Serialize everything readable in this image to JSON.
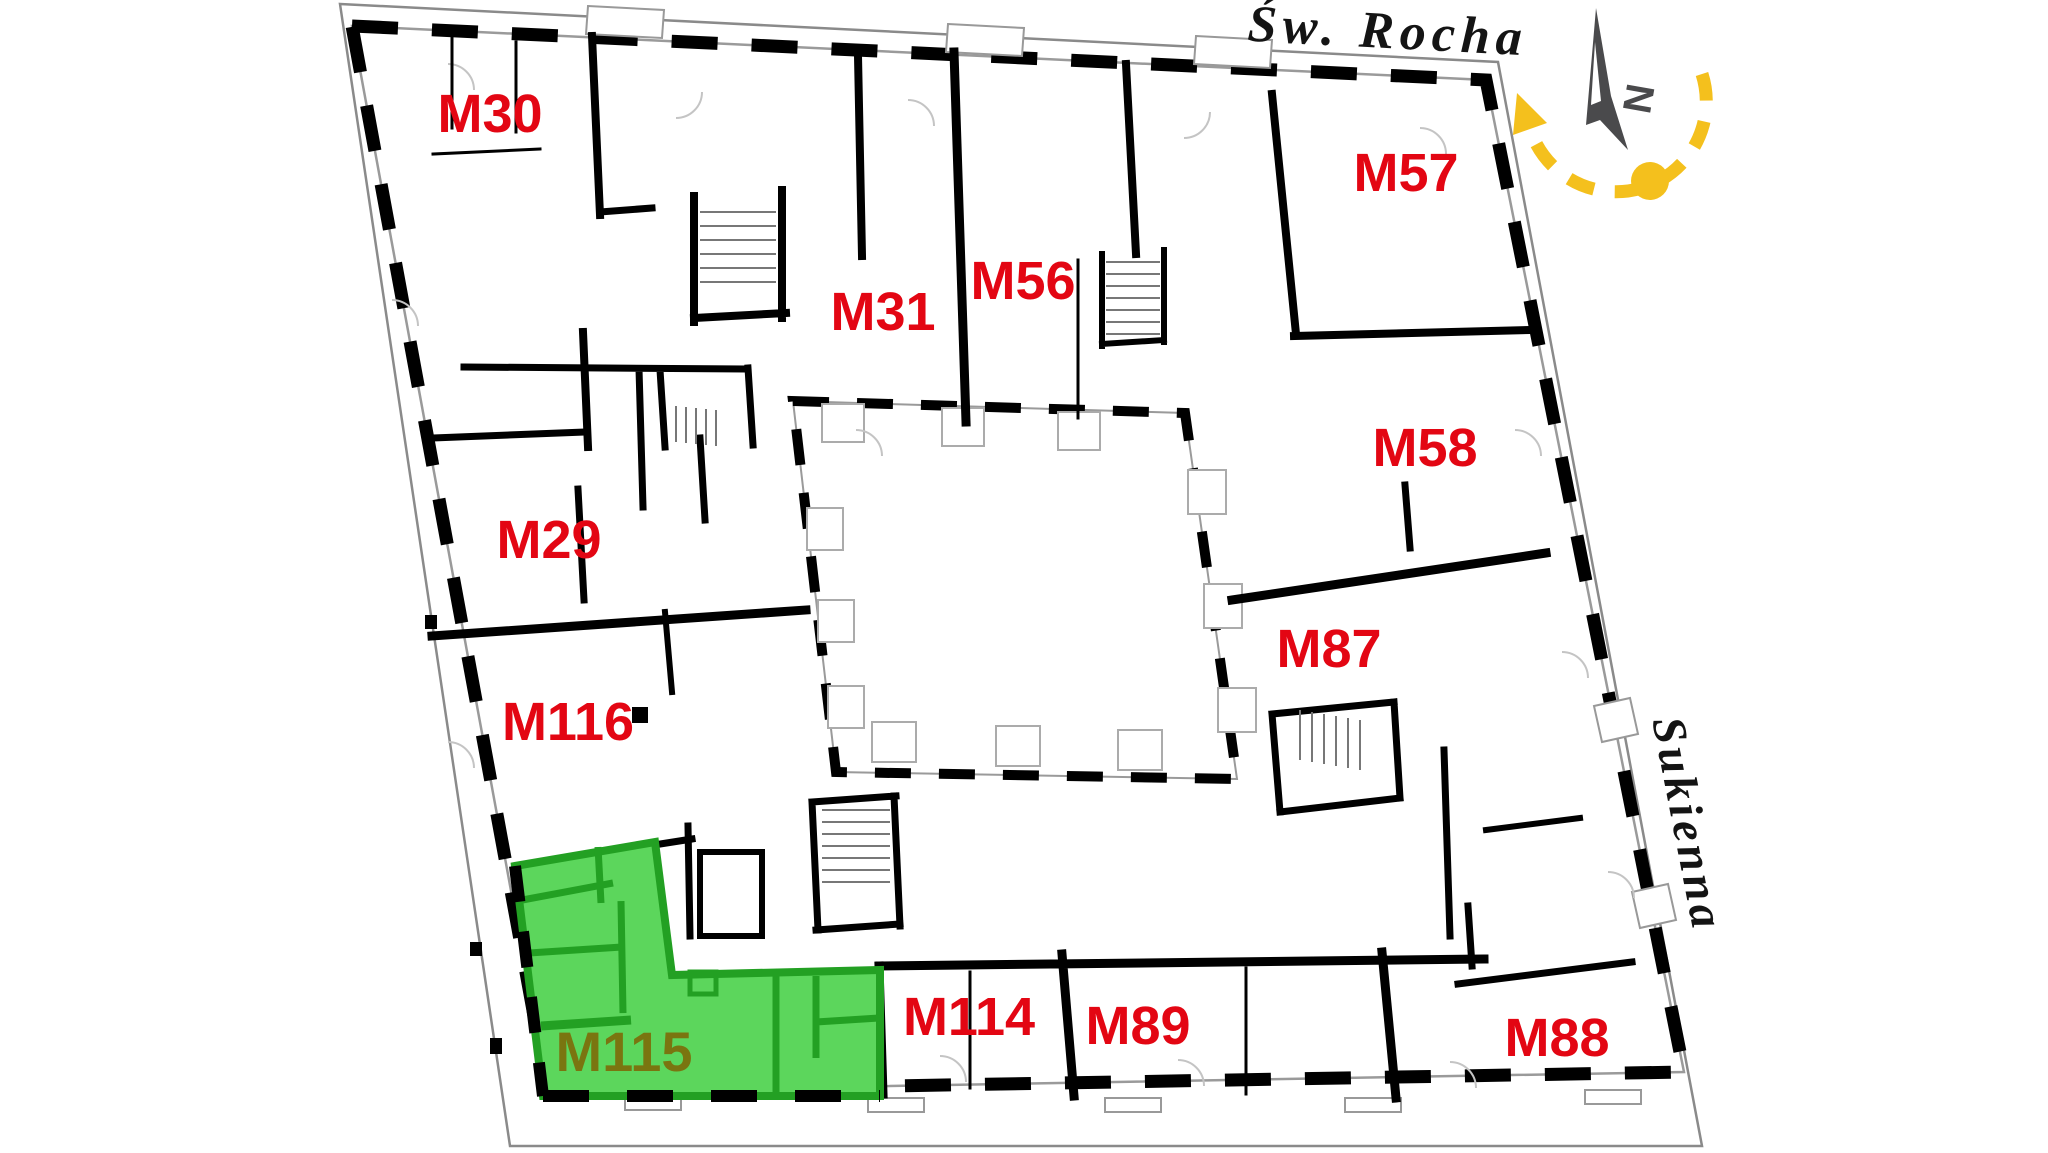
{
  "streets": {
    "top": {
      "name": "Św. Rocha"
    },
    "right": {
      "name": "Sukienna"
    }
  },
  "compass": {
    "north_label": "N"
  },
  "highlighted_unit": "M115",
  "units": [
    {
      "label": "M30",
      "highlighted": false
    },
    {
      "label": "M57",
      "highlighted": false
    },
    {
      "label": "M31",
      "highlighted": false
    },
    {
      "label": "M56",
      "highlighted": false
    },
    {
      "label": "M58",
      "highlighted": false
    },
    {
      "label": "M29",
      "highlighted": false
    },
    {
      "label": "M87",
      "highlighted": false
    },
    {
      "label": "M116",
      "highlighted": false
    },
    {
      "label": "M115",
      "highlighted": true
    },
    {
      "label": "M114",
      "highlighted": false
    },
    {
      "label": "M89",
      "highlighted": false
    },
    {
      "label": "M88",
      "highlighted": false
    }
  ],
  "colors": {
    "unit_label": "#e30613",
    "highlight_fill": "#5cd65c",
    "highlight_wall": "#23a023",
    "highlight_label": "#7a7510",
    "sun_accent": "#f4c01d",
    "needle": "#4a4a4c",
    "wall": "#000000",
    "plot_line": "#8a8a8a"
  }
}
